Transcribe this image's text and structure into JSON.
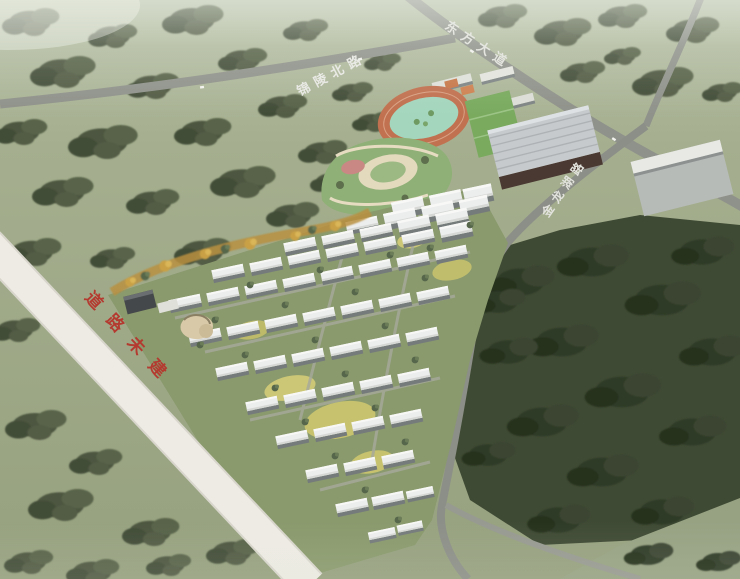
{
  "scene": {
    "description": "Aerial bird's-eye architectural rendering of a residential master plan with sports park, gymnasium and surrounding farmland"
  },
  "roads": {
    "jinling_north_road": {
      "label": "锦陵北路"
    },
    "dongfang_avenue": {
      "label": "东方大道"
    },
    "jinlonghu_road": {
      "label": "金龙湖路"
    },
    "unbuilt_road_note": {
      "label": "道路未建",
      "label_color": "#b43a30"
    }
  },
  "colors": {
    "field_green": "#9fa989",
    "forest_dark": "#39432f",
    "road_gray": "#8f928a",
    "road_white": "#edebe3",
    "unbuilt_text_red": "#b43a30",
    "track_ring_orange": "#c1714f",
    "track_infield": "#a4d6bd",
    "court_green": "#79aa5e",
    "apartment_roof_white": "#eceded",
    "autumn_tree_orange": "#c9a045",
    "gym_roof_gray": "#c6cacc"
  }
}
